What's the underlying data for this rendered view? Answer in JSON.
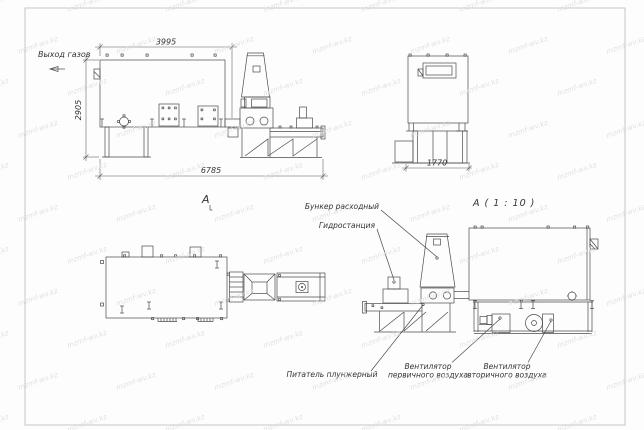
{
  "watermark": {
    "text": "mzmf-wv.kz",
    "color": "#dcdcdc"
  },
  "drawing": {
    "line_color": "#4a4a4a",
    "views": {
      "side_elevation": {
        "gas_outlet_label": "Выход газов",
        "dims": {
          "top_width": "3995",
          "left_height": "2905",
          "bottom_width": "6785"
        }
      },
      "end_elevation": {
        "dims": {
          "bottom_width": "1770"
        }
      },
      "top_view": {
        "section_label": "A"
      },
      "detail_view": {
        "title": "А ( 1 : 10 )",
        "callouts": {
          "hopper": "Бункер расходный",
          "hydrostation": "Гидростанция",
          "plunger_feeder": "Питатель плунжерный",
          "primary_fan": [
            "Вентилятор",
            "первичного воздуха"
          ],
          "secondary_fan": [
            "Вентилятор",
            "вторичного воздуха"
          ]
        }
      }
    }
  }
}
